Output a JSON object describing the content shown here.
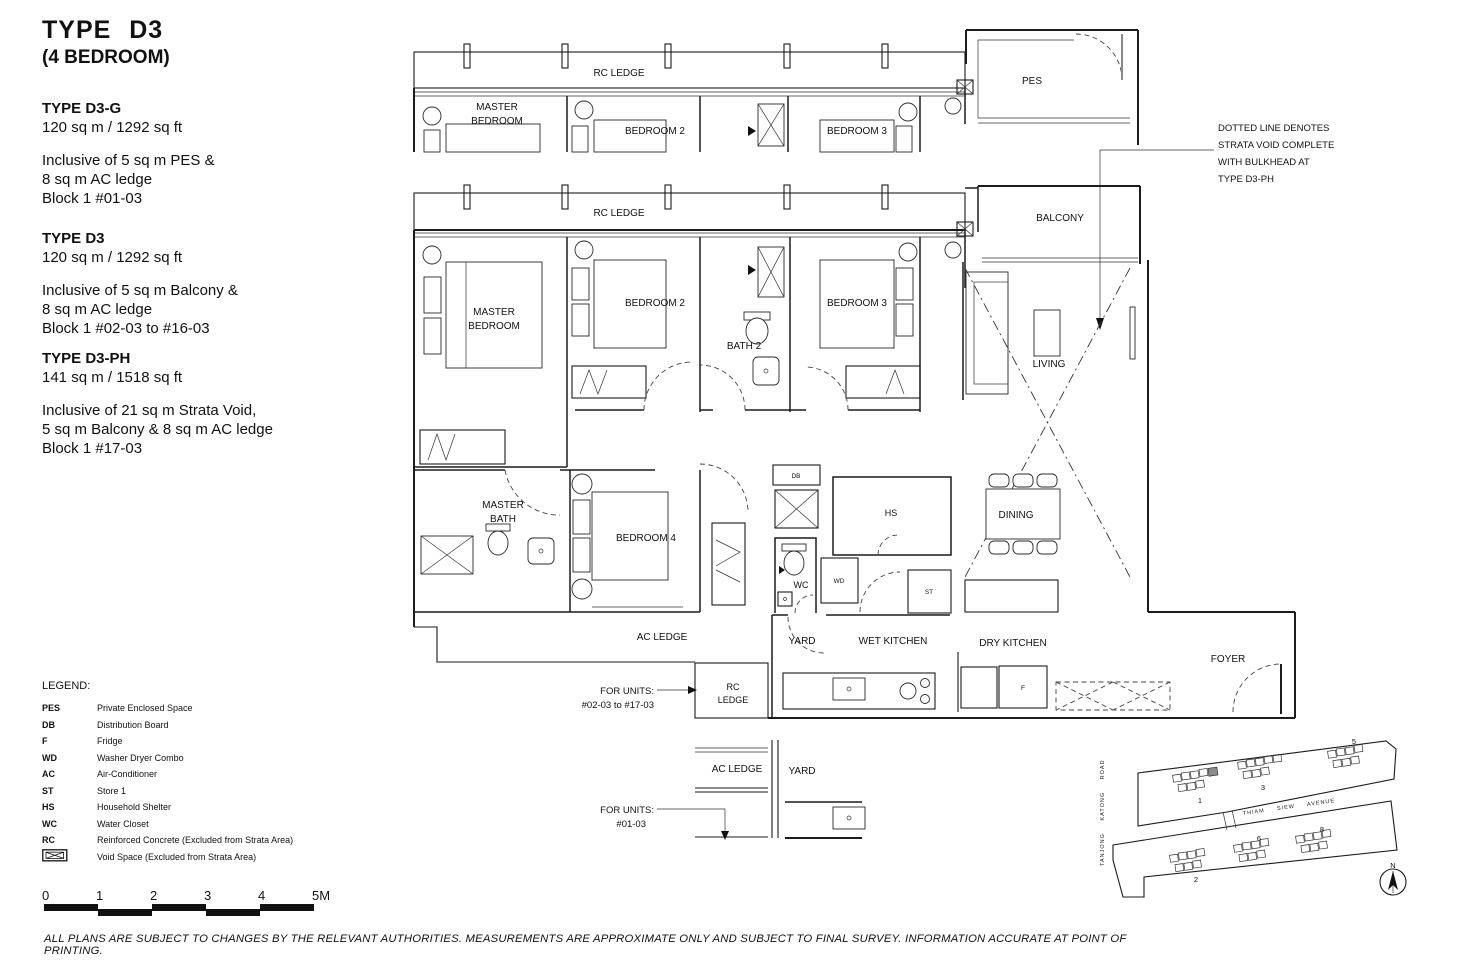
{
  "header": {
    "title": "TYPE D3",
    "subtitle": "(4 BEDROOM)"
  },
  "variants": [
    {
      "name": "TYPE D3-G",
      "area": "120 sq m / 1292 sq ft",
      "lines": [
        "Inclusive of 5 sq m PES &",
        "8 sq m AC ledge",
        "Block 1 #01-03"
      ]
    },
    {
      "name": "TYPE D3",
      "area": "120 sq m / 1292 sq ft",
      "lines": [
        "Inclusive of 5 sq m Balcony &",
        "8 sq m AC ledge",
        "Block 1 #02-03 to #16-03"
      ]
    },
    {
      "name": "TYPE D3-PH",
      "area": "141 sq m / 1518 sq ft",
      "lines": [
        "Inclusive of 21 sq m Strata Void,",
        "5 sq m Balcony & 8 sq m AC ledge",
        "Block 1 #17-03"
      ]
    }
  ],
  "legend": {
    "title": "LEGEND:",
    "items": [
      {
        "abbr": "PES",
        "desc": "Private Enclosed Space"
      },
      {
        "abbr": "DB",
        "desc": "Distribution Board"
      },
      {
        "abbr": "F",
        "desc": "Fridge"
      },
      {
        "abbr": "WD",
        "desc": "Washer Dryer Combo"
      },
      {
        "abbr": "AC",
        "desc": "Air-Conditioner"
      },
      {
        "abbr": "ST",
        "desc": "Store 1"
      },
      {
        "abbr": "HS",
        "desc": "Household Shelter"
      },
      {
        "abbr": "WC",
        "desc": "Water Closet"
      },
      {
        "abbr": "RC",
        "desc": "Reinforced Concrete (Excluded from Strata Area)"
      }
    ],
    "void_item": {
      "desc": "Void Space (Excluded from Strata Area)",
      "icon": "void-space-symbol"
    }
  },
  "scale_bar": {
    "ticks": [
      "0",
      "1",
      "2",
      "3",
      "4",
      "5M"
    ]
  },
  "note": {
    "lines": [
      "DOTTED LINE DENOTES",
      "STRATA VOID COMPLETE",
      "WITH BULKHEAD AT",
      "TYPE D3-PH"
    ]
  },
  "plan": {
    "labels": {
      "rc_ledge": "RC LEDGE",
      "master_bedroom": [
        "MASTER",
        "BEDROOM"
      ],
      "bedroom2": "BEDROOM 2",
      "bedroom3": "BEDROOM 3",
      "bedroom4": "BEDROOM 4",
      "bath2": "BATH 2",
      "pes": "PES",
      "balcony": "BALCONY",
      "living": "LIVING",
      "dining": "DINING",
      "master_bath": [
        "MASTER",
        "BATH"
      ],
      "db": "DB",
      "hs": "HS",
      "wc": "WC",
      "wd": "WD",
      "st": "ST",
      "f": "F",
      "ac_ledge": "AC LEDGE",
      "yard": "YARD",
      "wet_kitchen": "WET KITCHEN",
      "dry_kitchen": "DRY KITCHEN",
      "foyer": "FOYER",
      "rc_ledge_box": [
        "RC",
        "LEDGE"
      ]
    },
    "callouts": {
      "units_upper": [
        "FOR UNITS:",
        "#02-03 to #17-03"
      ],
      "units_ground": [
        "FOR UNITS:",
        "#01-03"
      ]
    }
  },
  "site_plan": {
    "road_vertical": "TANJONG KATONG ROAD",
    "road_between": "THIAM SIEW AVENUE",
    "blocks": [
      "1",
      "3",
      "5",
      "2",
      "6",
      "8"
    ],
    "compass": "N",
    "highlight_color": "#8a8a8a"
  },
  "disclaimer": "ALL PLANS ARE SUBJECT TO CHANGES BY THE RELEVANT AUTHORITIES. MEASUREMENTS ARE APPROXIMATE ONLY AND SUBJECT TO FINAL SURVEY. INFORMATION ACCURATE AT POINT OF PRINTING."
}
